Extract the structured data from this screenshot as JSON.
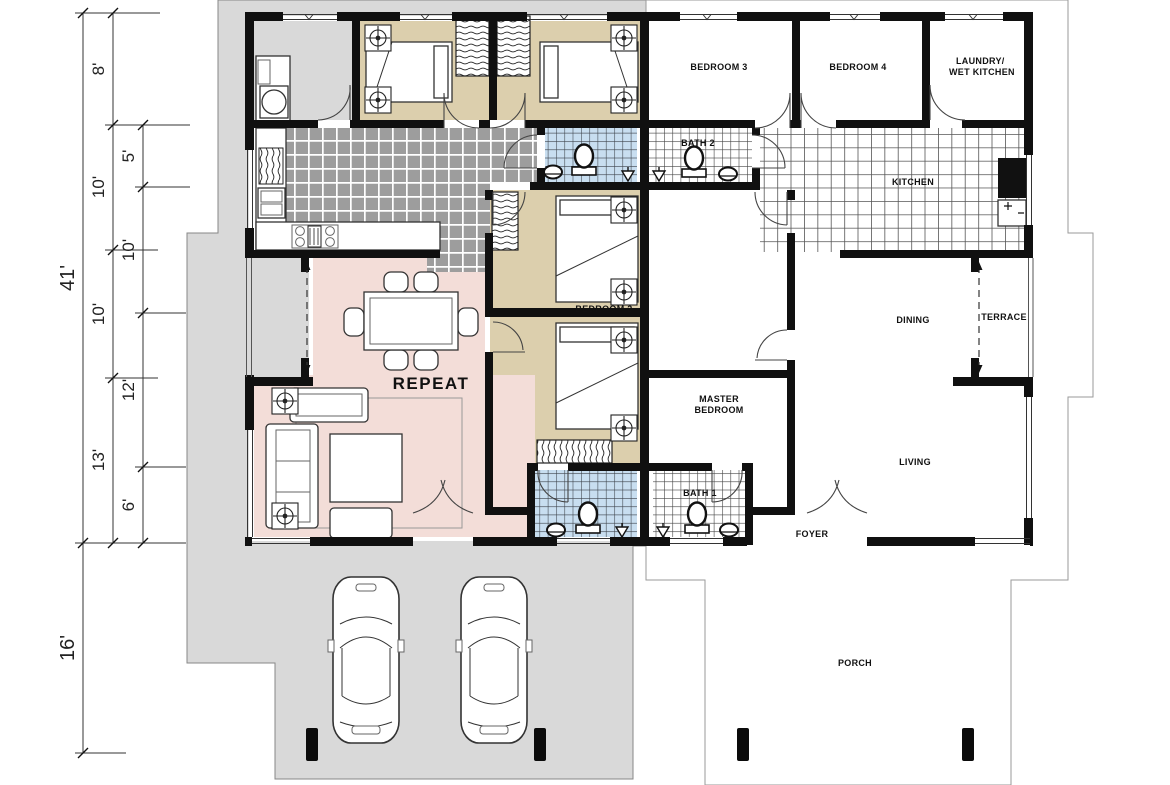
{
  "drawing": {
    "type": "floor-plan",
    "unit_note": "REPEAT"
  },
  "rooms": {
    "bedroom3": "BEDROOM 3",
    "bedroom4": "BEDROOM 4",
    "laundry_line1": "LAUNDRY/",
    "laundry_line2": "WET KITCHEN",
    "bath2": "BATH 2",
    "kitchen": "KITCHEN",
    "dining": "DINING",
    "terrace": "TERRACE",
    "master_line1": "MASTER",
    "master_line2": "BEDROOM",
    "living": "LIVING",
    "bath1": "BATH 1",
    "foyer": "FOYER",
    "porch": "PORCH",
    "bedroom2": "BEDROOM 2",
    "repeat_note": "REPEAT"
  },
  "dims": {
    "outer": [
      "41'",
      "16'"
    ],
    "middle": [
      "8'",
      "10'",
      "10'",
      "13'"
    ],
    "inner": [
      "5'",
      "10'",
      "12'",
      "6'"
    ]
  },
  "colors": {
    "wall": "#101010",
    "tan": "#dccfad",
    "pink": "#f3ddd8",
    "bath_blue": "#c8def0",
    "tile_dark": "#9d9d9d",
    "outline_gray": "#d9d9d9",
    "label": "#111111"
  }
}
